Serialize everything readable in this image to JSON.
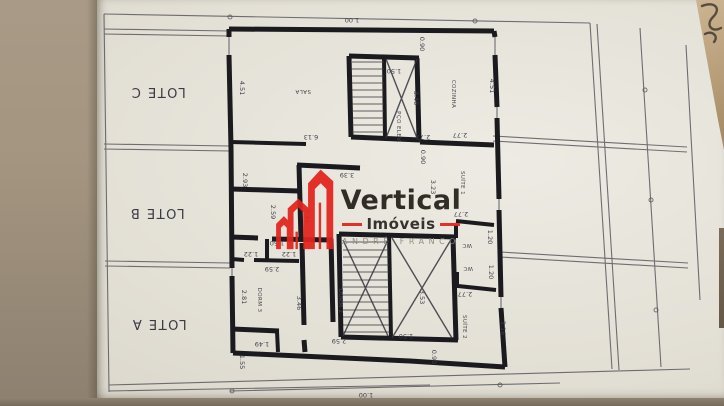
{
  "logo": {
    "brand": "Vertical",
    "sub": "Imóveis",
    "agent": "ANDRÉ FRANCO",
    "accent_color": "#e3241d",
    "text_color": "#242019",
    "agent_color": "#8f887a"
  },
  "plan": {
    "type": "architectural-floor-plan-photo",
    "lots": [
      {
        "label": "LOTE C",
        "x": 158,
        "y": 88,
        "rot": 180
      },
      {
        "label": "LOTE B",
        "x": 157,
        "y": 209,
        "rot": 180
      },
      {
        "label": "LOTE A",
        "x": 159,
        "y": 320,
        "rot": 180
      }
    ],
    "rooms": [
      {
        "label": "SALA",
        "x": 303,
        "y": 90,
        "rot": 180,
        "size": 6.5
      },
      {
        "label": "COZINHA",
        "x": 452,
        "y": 94,
        "rot": 90,
        "size": 5
      },
      {
        "label": "PÇO ELEV.",
        "x": 397,
        "y": 127,
        "rot": 90,
        "size": 4.5
      },
      {
        "label": "SUÍTE 1",
        "x": 461,
        "y": 183,
        "rot": 90,
        "size": 5
      },
      {
        "label": "WC",
        "x": 467,
        "y": 244,
        "rot": 180,
        "size": 4.5
      },
      {
        "label": "WC",
        "x": 468,
        "y": 267,
        "rot": 180,
        "size": 4.5
      },
      {
        "label": "SUÍTE 2",
        "x": 463,
        "y": 327,
        "rot": 90,
        "size": 5
      },
      {
        "label": "DORM 3",
        "x": 258,
        "y": 300,
        "rot": 90,
        "size": 5.5
      },
      {
        "label": "DORM 2",
        "x": 339,
        "y": 301,
        "rot": 90,
        "size": 5.5
      }
    ],
    "dimensions": [
      {
        "label": "1.00",
        "x": 352,
        "y": 18,
        "rot": 180
      },
      {
        "label": "0.90",
        "x": 420,
        "y": 44,
        "rot": 90
      },
      {
        "label": "1.50",
        "x": 394,
        "y": 69,
        "rot": 180
      },
      {
        "label": "4.51",
        "x": 240,
        "y": 88,
        "rot": 90
      },
      {
        "label": "4.51",
        "x": 490,
        "y": 86,
        "rot": 90
      },
      {
        "label": "3.46",
        "x": 414,
        "y": 98,
        "rot": 90
      },
      {
        "label": "6.13",
        "x": 311,
        "y": 135,
        "rot": 180
      },
      {
        "label": "2.77",
        "x": 423,
        "y": 135,
        "rot": 180
      },
      {
        "label": "2.77",
        "x": 460,
        "y": 133,
        "rot": 180
      },
      {
        "label": "0.90",
        "x": 421,
        "y": 157,
        "rot": 90
      },
      {
        "label": "3.39",
        "x": 347,
        "y": 173,
        "rot": 180
      },
      {
        "label": "2.93",
        "x": 243,
        "y": 180,
        "rot": 90
      },
      {
        "label": "3.23",
        "x": 431,
        "y": 187,
        "rot": 90
      },
      {
        "label": "2.59",
        "x": 271,
        "y": 212,
        "rot": 90
      },
      {
        "label": "3.46",
        "x": 305,
        "y": 216,
        "rot": 90
      },
      {
        "label": "2.77",
        "x": 461,
        "y": 212,
        "rot": 180
      },
      {
        "label": "1.20",
        "x": 488,
        "y": 237,
        "rot": 90
      },
      {
        "label": "1.50",
        "x": 277,
        "y": 241,
        "rot": 180
      },
      {
        "label": "1.22",
        "x": 251,
        "y": 252,
        "rot": 180
      },
      {
        "label": "1.22",
        "x": 289,
        "y": 252,
        "rot": 180
      },
      {
        "label": "2.59",
        "x": 272,
        "y": 267,
        "rot": 180
      },
      {
        "label": "1.20",
        "x": 489,
        "y": 272,
        "rot": 90
      },
      {
        "label": "2.81",
        "x": 242,
        "y": 297,
        "rot": 90
      },
      {
        "label": "3.46",
        "x": 297,
        "y": 303,
        "rot": 90
      },
      {
        "label": "2.77",
        "x": 465,
        "y": 292,
        "rot": 180
      },
      {
        "label": "3.53",
        "x": 420,
        "y": 297,
        "rot": 90
      },
      {
        "label": "3.16",
        "x": 501,
        "y": 328,
        "rot": 90
      },
      {
        "label": "1.50",
        "x": 406,
        "y": 334,
        "rot": 180
      },
      {
        "label": "2.59",
        "x": 339,
        "y": 339,
        "rot": 180
      },
      {
        "label": "1.49",
        "x": 262,
        "y": 342,
        "rot": 180
      },
      {
        "label": "1.55",
        "x": 240,
        "y": 362,
        "rot": 90
      },
      {
        "label": "0.90",
        "x": 432,
        "y": 357,
        "rot": 90
      },
      {
        "label": "1.00",
        "x": 366,
        "y": 393,
        "rot": 180
      }
    ],
    "colors": {
      "wall": "#1b1b1f",
      "thin_line": "#5a5860",
      "paper": "#e5e2d8"
    }
  }
}
